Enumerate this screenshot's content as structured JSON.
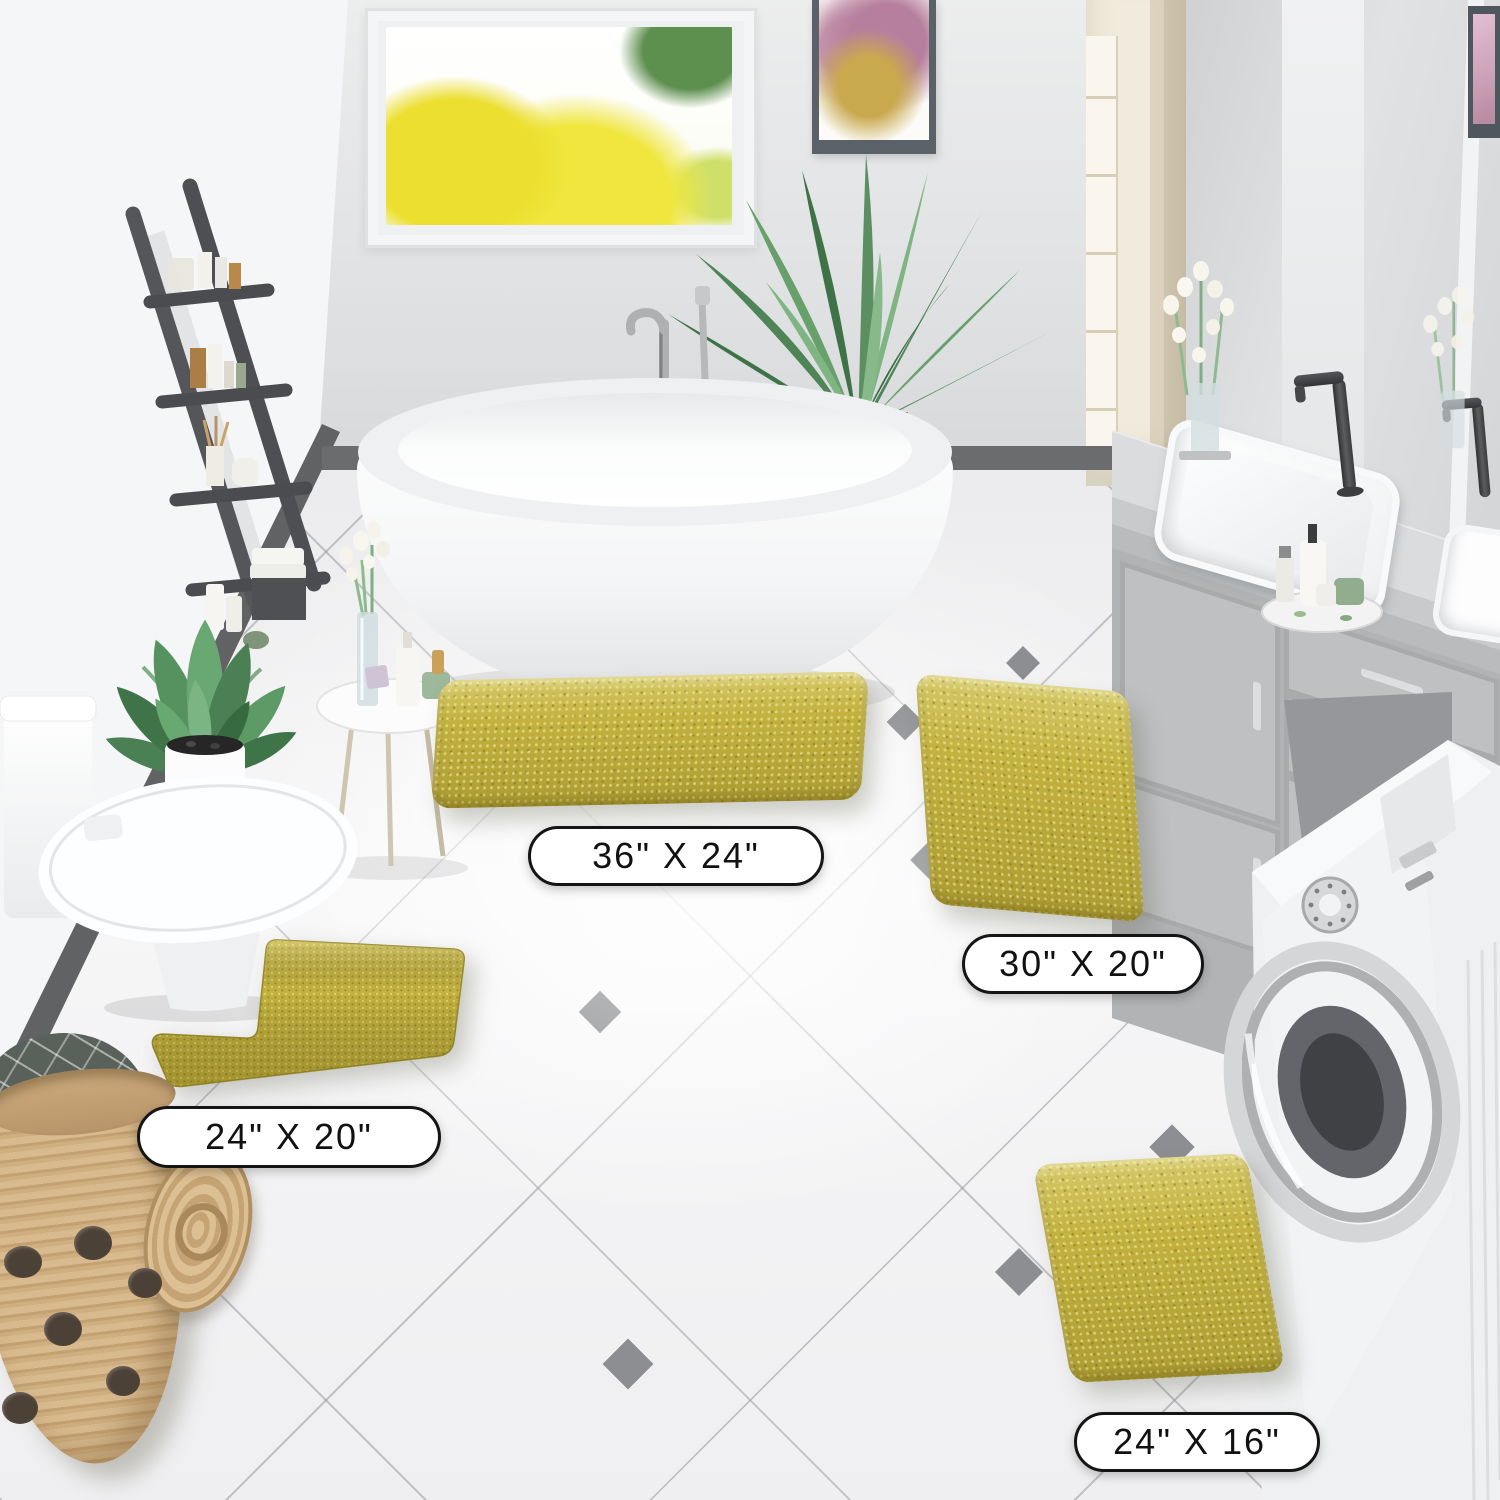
{
  "scene": {
    "title": "Bathroom scene with four chenille bath rugs",
    "labels": [
      {
        "id": "rug-36x24",
        "text": "36\" X 24\""
      },
      {
        "id": "rug-30x20",
        "text": "30\" X 20\""
      },
      {
        "id": "rug-24x20",
        "text": "24\" X 20\""
      },
      {
        "id": "rug-24x16",
        "text": "24\" X 16\""
      }
    ],
    "colors": {
      "rug": "#c3b23e",
      "rug_light": "#ddd06a",
      "rug_dark": "#978834",
      "floor": "#f3f3f5",
      "wall": "#e1e2e4",
      "left_wall": "#f5f6f7",
      "baseboard": "#606264",
      "label_bg": "#ffffff",
      "label_border": "#151515",
      "label_text": "#111111"
    }
  }
}
